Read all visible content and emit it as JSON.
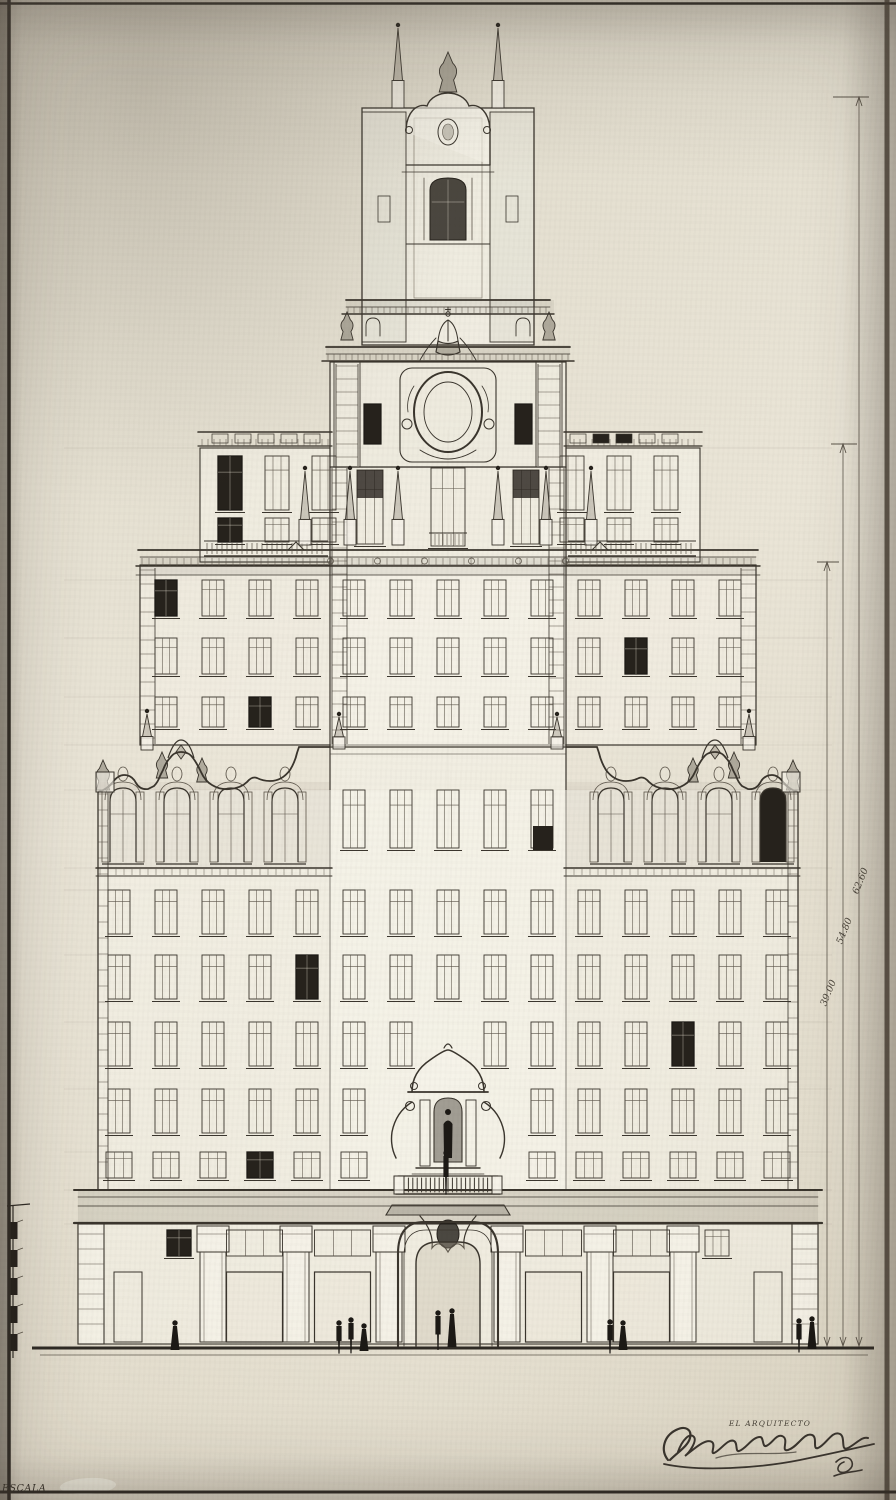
{
  "sheet": {
    "caption_architect": "EL ARQUITECTO",
    "scale_label": "ESCALA",
    "dimensions": {
      "outer": "62.60",
      "middle": "54.80",
      "inner": "39.00"
    }
  }
}
